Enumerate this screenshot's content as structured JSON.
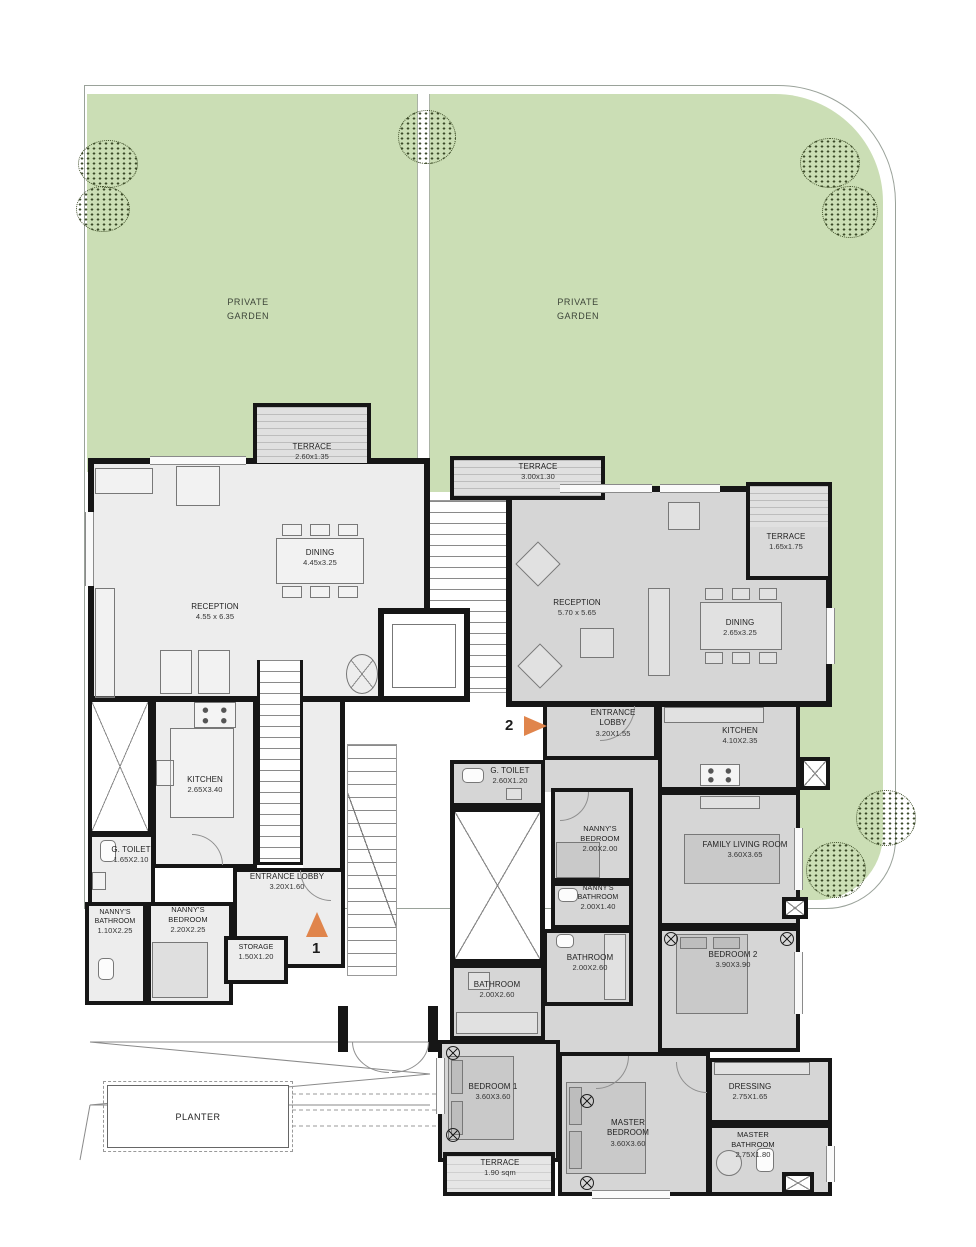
{
  "site": {
    "garden_left_label": "PRIVATE GARDEN",
    "garden_right_label": "PRIVATE GARDEN",
    "planter_label": "PLANTER"
  },
  "markers": {
    "unit1_entry": "1",
    "unit2_entry": "2"
  },
  "unit1": {
    "rooms": {
      "terrace": {
        "name": "TERRACE",
        "dims": "2.60x1.35"
      },
      "dining": {
        "name": "DINING",
        "dims": "4.45x3.25"
      },
      "reception": {
        "name": "RECEPTION",
        "dims": "4.55 x 6.35"
      },
      "kitchen": {
        "name": "KITCHEN",
        "dims": "2.65X3.40"
      },
      "g_toilet": {
        "name": "G. TOILET",
        "dims": "1.65X2.10"
      },
      "nannys_bathroom": {
        "name": "NANNY'S BATHROOM",
        "dims": "1.10X2.25"
      },
      "nannys_bedroom": {
        "name": "NANNY'S BEDROOM",
        "dims": "2.20X2.25"
      },
      "entrance_lobby": {
        "name": "ENTRANCE LOBBY",
        "dims": "3.20X1.60"
      },
      "storage": {
        "name": "STORAGE",
        "dims": "1.50X1.20"
      }
    }
  },
  "unit2": {
    "rooms": {
      "terrace_top": {
        "name": "TERRACE",
        "dims": "3.00x1.30"
      },
      "reception": {
        "name": "RECEPTION",
        "dims": "5.70 x 5.65"
      },
      "terrace_east": {
        "name": "TERRACE",
        "dims": "1.65x1.75"
      },
      "dining": {
        "name": "DINING",
        "dims": "2.65x3.25"
      },
      "kitchen": {
        "name": "KITCHEN",
        "dims": "4.10X2.35"
      },
      "entrance_lobby": {
        "name": "ENTRANCE LOBBY",
        "dims": "3.20X1.55"
      },
      "g_toilet": {
        "name": "G. TOILET",
        "dims": "2.60X1.20"
      },
      "nannys_bedroom": {
        "name": "NANNY'S BEDROOM",
        "dims": "2.00X2.00"
      },
      "nannys_bathroom": {
        "name": "NANNY'S BATHROOM",
        "dims": "2.00X1.40"
      },
      "bathroom_a": {
        "name": "BATHROOM",
        "dims": "2.00X2.60"
      },
      "bathroom_b": {
        "name": "BATHROOM",
        "dims": "2.00X2.60"
      },
      "family_living_room": {
        "name": "FAMILY LIVING ROOM",
        "dims": "3.60X3.65"
      },
      "bedroom_2": {
        "name": "BEDROOM 2",
        "dims": "3.90X3.90"
      },
      "bedroom_1": {
        "name": "BEDROOM 1",
        "dims": "3.60X3.60"
      },
      "terrace_south": {
        "name": "TERRACE",
        "dims": "1.90 sqm"
      },
      "master_bedroom": {
        "name": "MASTER BEDROOM",
        "dims": "3.60X3.60"
      },
      "dressing": {
        "name": "DRESSING",
        "dims": "2.75X1.65"
      },
      "master_bathroom": {
        "name": "MASTER BATHROOM",
        "dims": "2.75X1.80"
      }
    }
  },
  "colors": {
    "garden": "#cbdeb5",
    "unit1_floor": "#ededed",
    "unit2_floor": "#d6d6d6",
    "terrace_fill": "#e0e0e0",
    "wall": "#161616",
    "entry_arrow": "#e0854c"
  }
}
